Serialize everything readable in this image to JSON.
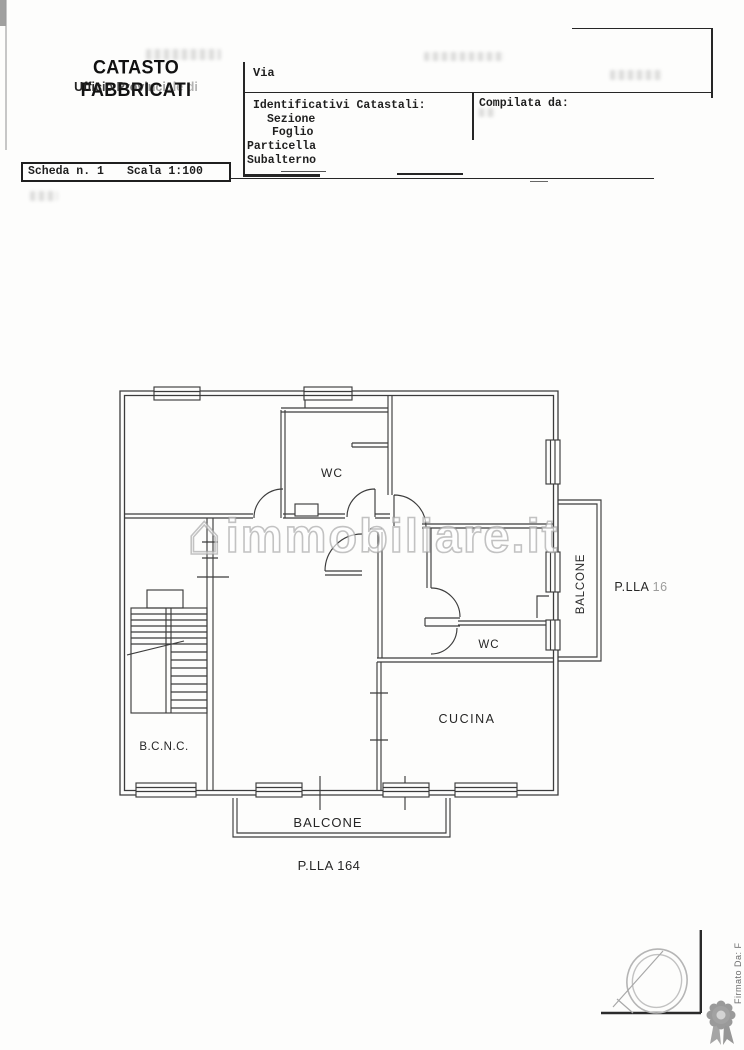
{
  "header": {
    "title": "CATASTO FABBRICATI",
    "subtitle": "Ufficio Provinciale di",
    "sheet_box": {
      "scheda": "Scheda n. 1",
      "scala": "Scala 1:100"
    },
    "form": {
      "via_label": "Via",
      "identificativi_label": "Identificativi Catastali:",
      "sezione_label": "Sezione",
      "foglio_label": "Foglio",
      "particella_label": "Particella",
      "subalterno_label": "Subalterno",
      "compilata_label": "Compilata da:"
    }
  },
  "plan": {
    "labels": {
      "wc_top": "WC",
      "wc_mid": "WC",
      "cucina": "CUCINA",
      "bcnc": "B.C.N.C.",
      "balcone_bottom": "BALCONE",
      "balcone_right": "BALCONE",
      "plla_bottom": "P.LLA 164",
      "plla_right": "P.LLA 16"
    }
  },
  "watermark": {
    "text": "immobiliare.it",
    "icon": "house-icon"
  },
  "footer": {
    "signature_vertical": "Firmato Da: F",
    "seal": "rosette-ribbon-icon",
    "stamp": "notary-stamp-icon"
  }
}
